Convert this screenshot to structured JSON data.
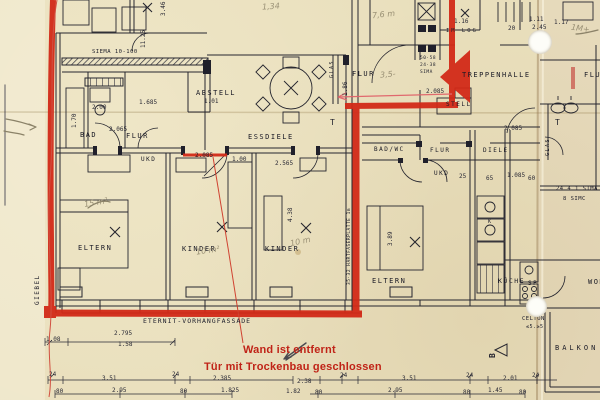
{
  "document_type": "architectural floor plan scan with red marker annotations",
  "plan": {
    "rooms": {
      "bad": "BAD",
      "flur_left": "FLUR",
      "essdiele": "ESSDIELE",
      "abstell": "ABSTELL",
      "ukd_left": "UKD",
      "eltern_left": "ELTERN",
      "kinder_1": "KINDER",
      "kinder_2": "KINDER",
      "eltern_right": "ELTERN",
      "kueche": "KÜCHE",
      "sp": "SP",
      "treppenhalle": "TREPPENHALLE",
      "flur_mid_top": "FLUR",
      "bad_wc": "BAD/WC",
      "flur_mid": "FLUR",
      "diele": "DIELE",
      "ukd_right": "UKD",
      "balkon": "BALKON",
      "flur_far_right": "FLUR",
      "wohnen_partial": "WOH",
      "stell_partial": "STELL",
      "giebel": "GIEBEL",
      "glas_left": "GLAS",
      "glas_right": "GLAS"
    },
    "wall_labels": {
      "sima_top": "SIEMA 10-100",
      "fassade": "ETERNIT-VORHANGFASSADE",
      "hartfaser": "35·32 HARTFASERPLATTE 1m",
      "sima_right_1": "24 4 1 SIMA",
      "sima_right_2": "8 SIMC",
      "sima_stack_1": "50·58",
      "sima_stack_2": "24·38",
      "sima_stack_3": "SIMA",
      "im_log": "IM LOG",
      "celton_1": "CELTON",
      "celton_2": "≤5.≥5",
      "b_mark": "B",
      "t_mark_left": "T",
      "t_mark_right": "T",
      "k_mark": "K"
    },
    "red_annotations": {
      "line1": "Wand ist entfernt",
      "line2": "Tür mit Trockenbau geschlossen"
    },
    "dim_marks": [
      {
        "t": "1.08",
        "x": 46,
        "y": 336
      },
      {
        "t": "2.795",
        "x": 114,
        "y": 330
      },
      {
        "t": "1.58",
        "x": 118,
        "y": 341
      },
      {
        "t": "24",
        "x": 49,
        "y": 371
      },
      {
        "t": "3.51",
        "x": 102,
        "y": 375
      },
      {
        "t": "80",
        "x": 56,
        "y": 388
      },
      {
        "t": "2.95",
        "x": 112,
        "y": 387
      },
      {
        "t": "24",
        "x": 172,
        "y": 371
      },
      {
        "t": "2.385",
        "x": 213,
        "y": 375
      },
      {
        "t": "80",
        "x": 180,
        "y": 388
      },
      {
        "t": "1.825",
        "x": 221,
        "y": 387
      },
      {
        "t": "1.82",
        "x": 286,
        "y": 388
      },
      {
        "t": "2.38",
        "x": 297,
        "y": 378
      },
      {
        "t": "24",
        "x": 340,
        "y": 372
      },
      {
        "t": "3.51",
        "x": 402,
        "y": 375
      },
      {
        "t": "2.95",
        "x": 388,
        "y": 387
      },
      {
        "t": "80",
        "x": 315,
        "y": 389
      },
      {
        "t": "24",
        "x": 466,
        "y": 372
      },
      {
        "t": "2.01",
        "x": 503,
        "y": 375
      },
      {
        "t": "1.45",
        "x": 488,
        "y": 387
      },
      {
        "t": "24",
        "x": 532,
        "y": 372
      },
      {
        "t": "80",
        "x": 463,
        "y": 389
      },
      {
        "t": "80",
        "x": 519,
        "y": 389
      },
      {
        "t": "2.00",
        "x": 92,
        "y": 104
      },
      {
        "t": "1.685",
        "x": 139,
        "y": 99
      },
      {
        "t": "1.01",
        "x": 204,
        "y": 98
      },
      {
        "t": "2.065",
        "x": 109,
        "y": 126
      },
      {
        "t": "2.085",
        "x": 195,
        "y": 152
      },
      {
        "t": "1.00",
        "x": 232,
        "y": 156
      },
      {
        "t": "2.565",
        "x": 275,
        "y": 160
      },
      {
        "t": "1.16",
        "x": 454,
        "y": 18
      },
      {
        "t": "1.11",
        "x": 529,
        "y": 16
      },
      {
        "t": "2.45",
        "x": 532,
        "y": 24
      },
      {
        "t": "20",
        "x": 508,
        "y": 25
      },
      {
        "t": "1.17",
        "x": 554,
        "y": 19
      },
      {
        "t": "2.085",
        "x": 504,
        "y": 125
      },
      {
        "t": "1.085",
        "x": 507,
        "y": 172
      },
      {
        "t": "65",
        "x": 486,
        "y": 175
      },
      {
        "t": "60",
        "x": 528,
        "y": 175
      },
      {
        "t": "25",
        "x": 459,
        "y": 173
      },
      {
        "t": "2.085",
        "x": 426,
        "y": 88
      }
    ],
    "rot_marks": [
      {
        "t": "11.25",
        "x": 140,
        "y": 48
      },
      {
        "t": "3.46",
        "x": 160,
        "y": 16
      },
      {
        "t": "4.38",
        "x": 287,
        "y": 222
      },
      {
        "t": "3.89",
        "x": 387,
        "y": 246
      },
      {
        "t": "1.70",
        "x": 71,
        "y": 128
      },
      {
        "t": "1.86",
        "x": 342,
        "y": 96
      }
    ],
    "pencil_notes": [
      {
        "t": "15 m²",
        "x": 84,
        "y": 198,
        "r": -10
      },
      {
        "t": "10 m²",
        "x": 196,
        "y": 246,
        "r": -8
      },
      {
        "t": "10 m",
        "x": 290,
        "y": 237,
        "r": -12
      },
      {
        "t": "3,5-",
        "x": 380,
        "y": 70,
        "r": -5
      },
      {
        "t": "1M+",
        "x": 571,
        "y": 24,
        "r": 8
      },
      {
        "t": "7,6 m",
        "x": 372,
        "y": 10,
        "r": -6
      },
      {
        "t": "1,34",
        "x": 262,
        "y": 2,
        "r": -4
      }
    ],
    "colors": {
      "paper": "#e9dfbc",
      "ink": "#20202b",
      "marker_red": "#d22a18",
      "annotation_red": "#c02317",
      "pencil": "#8b8268"
    }
  }
}
